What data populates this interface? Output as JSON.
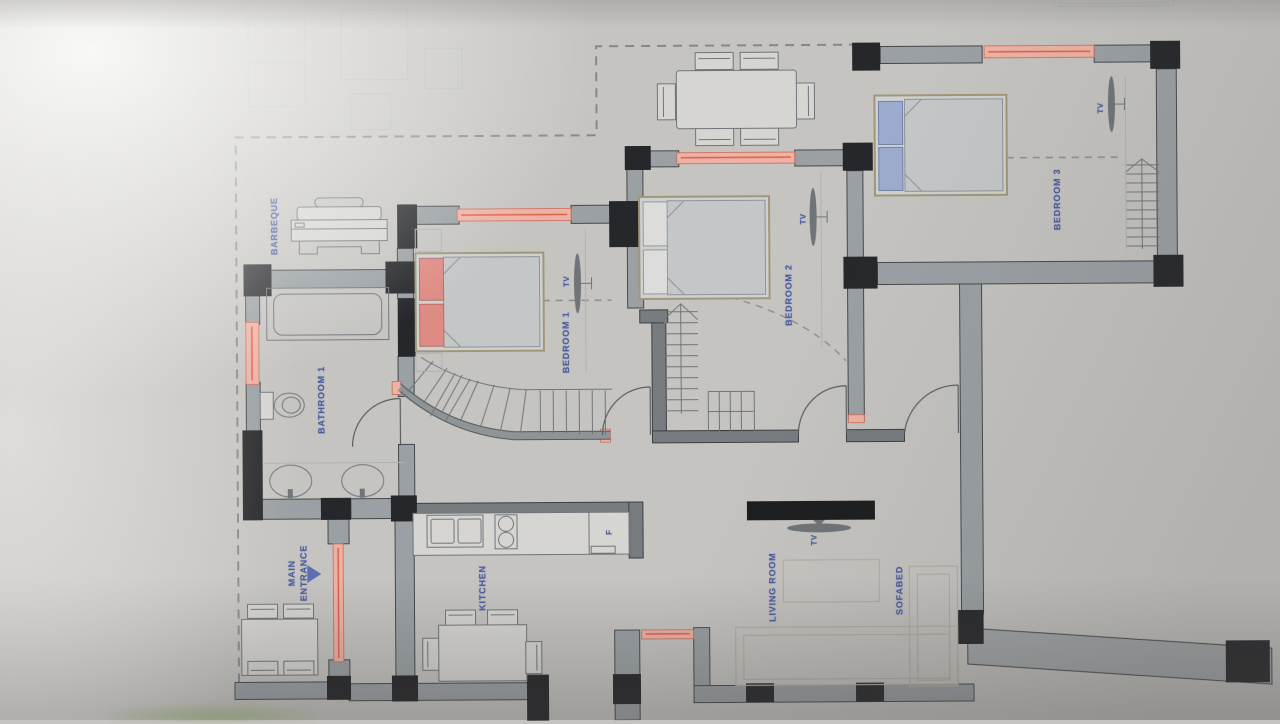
{
  "document": {
    "type": "architectural floor plan (photographed drawing)",
    "labels": {
      "barbeque": "BARBEQUE",
      "bathroom1": "BATHROOM 1",
      "bedroom1": "BEDROOM 1",
      "bedroom2": "BEDROOM 2",
      "bedroom3": "BEDROOM 3",
      "main_entrance": "MAIN ENTRANCE",
      "kitchen": "KITCHEN",
      "living_room": "LIVING ROOM",
      "sofabed": "SOFABED",
      "tv": "TV",
      "fridge": "F"
    },
    "colors": {
      "label_blue": "#4a5da0",
      "wall_gray": "#9aa0a4",
      "column_black": "#26272a",
      "window_pink": "#eeb2a4",
      "window_red": "#d9604f",
      "bed1_pillow_red": "#de8b84",
      "bed2_pillow_white": "#dcdddb",
      "bed3_pillow_blue": "#9dabce",
      "mattress_gray": "#c4c7c8",
      "paper_gray": "#c6c4c1",
      "tv_console_black": "#1c1d1e"
    }
  }
}
